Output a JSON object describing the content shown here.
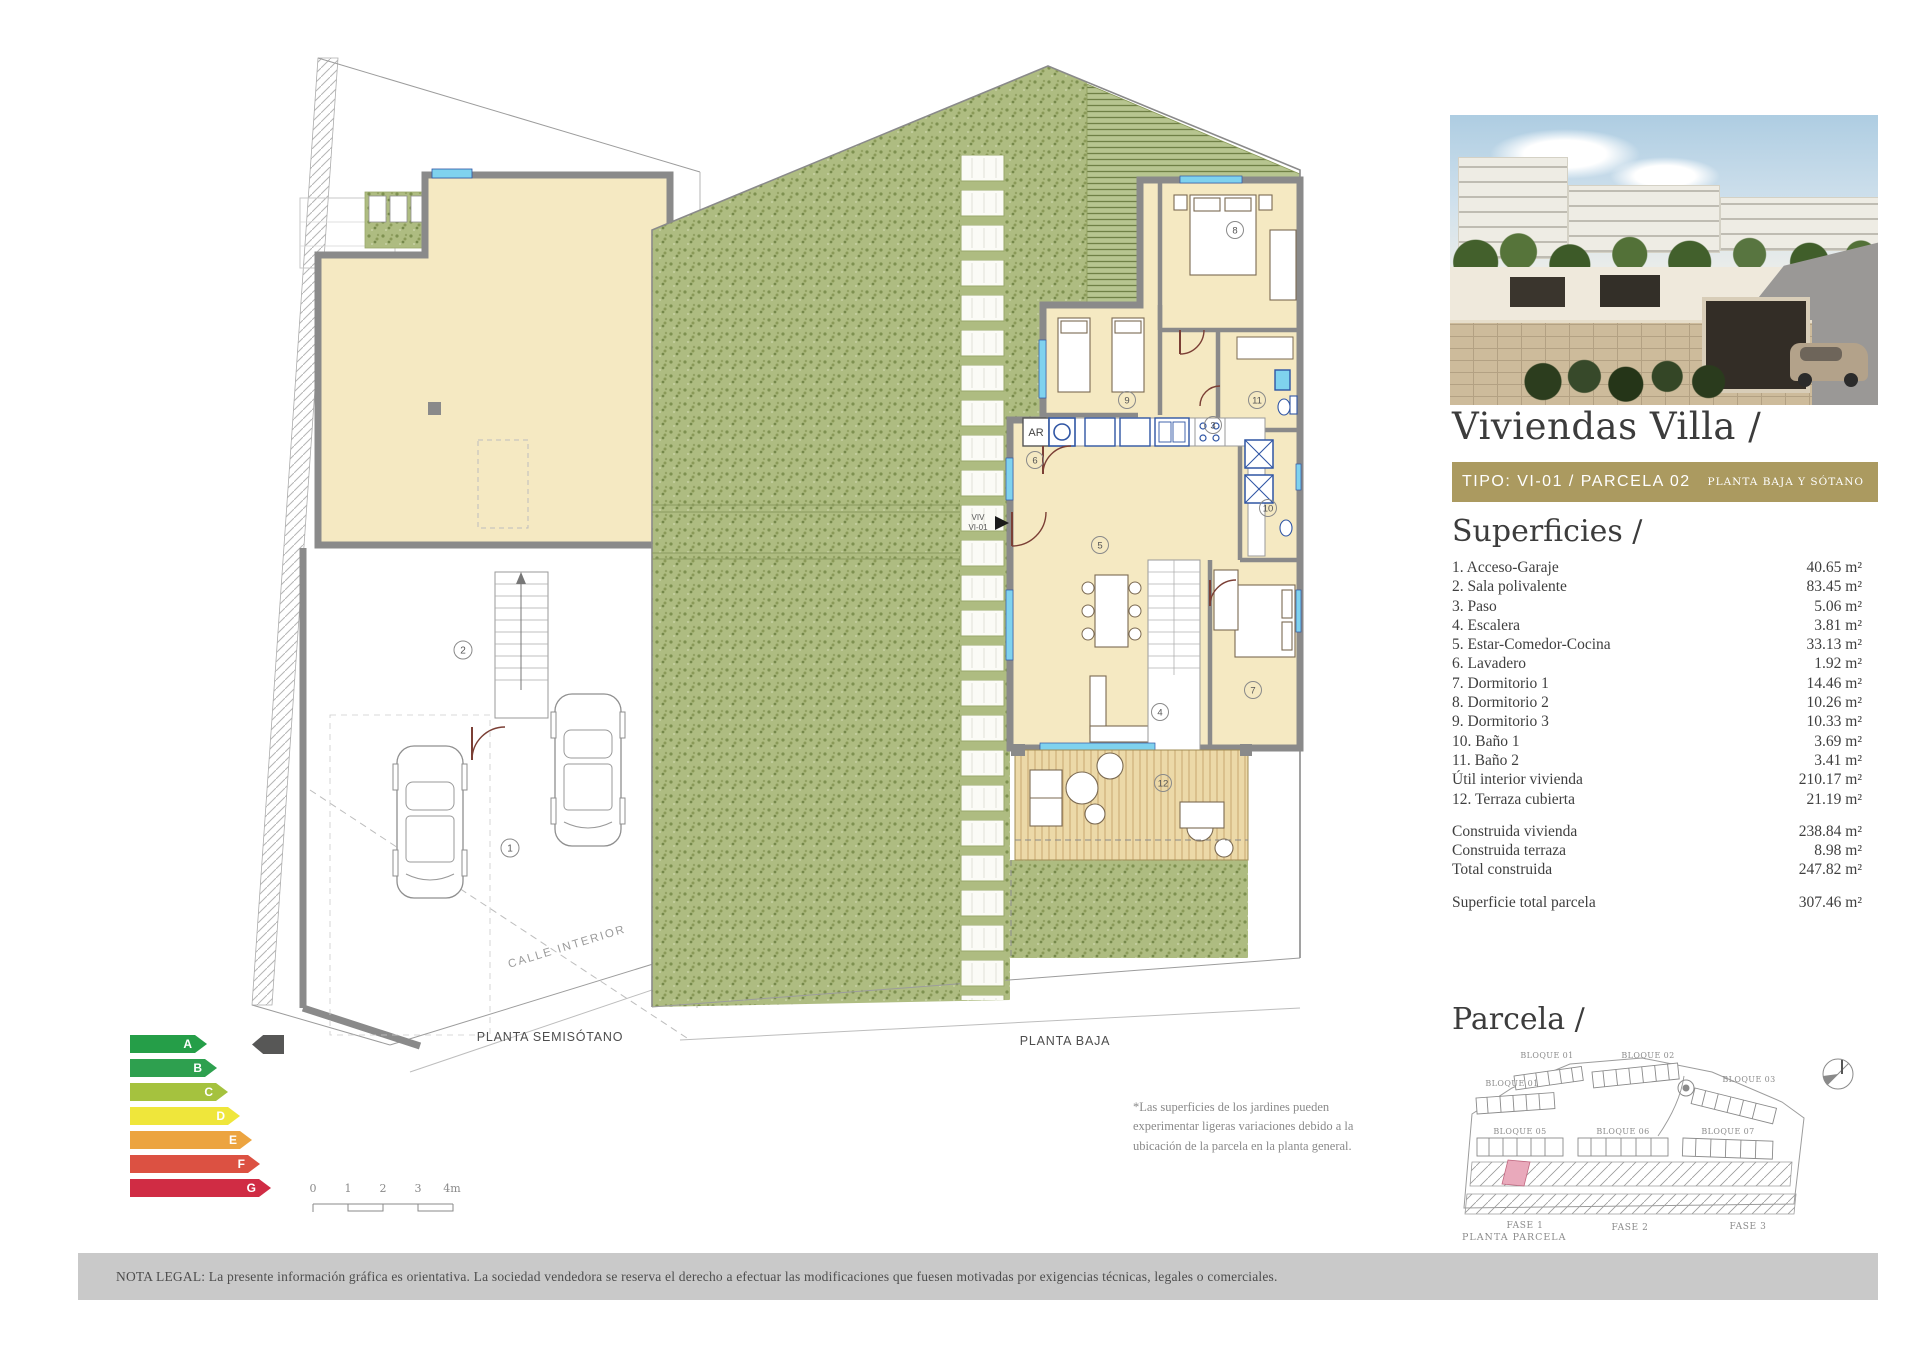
{
  "right_panel": {
    "title": "Viviendas Villa /",
    "type_bar": {
      "left": "TIPO: VI-01 / PARCELA 02",
      "right": "PLANTA BAJA Y SÓTANO",
      "bg": "#ab9a60"
    },
    "superficies": {
      "heading": "Superficies /",
      "rows": [
        {
          "label": "1. Acceso-Garaje",
          "value": "40.65 m²"
        },
        {
          "label": "2. Sala polivalente",
          "value": "83.45 m²"
        },
        {
          "label": "3. Paso",
          "value": "5.06 m²"
        },
        {
          "label": "4. Escalera",
          "value": "3.81 m²"
        },
        {
          "label": "5. Estar-Comedor-Cocina",
          "value": "33.13 m²"
        },
        {
          "label": "6. Lavadero",
          "value": "1.92 m²"
        },
        {
          "label": "7. Dormitorio 1",
          "value": "14.46 m²"
        },
        {
          "label": "8. Dormitorio 2",
          "value": "10.26 m²"
        },
        {
          "label": "9. Dormitorio 3",
          "value": "10.33 m²"
        },
        {
          "label": "10. Baño 1",
          "value": "3.69 m²"
        },
        {
          "label": "11. Baño 2",
          "value": "3.41 m²"
        },
        {
          "label": "Útil interior vivienda",
          "value": "210.17 m²"
        },
        {
          "label": "12. Terraza cubierta",
          "value": "21.19 m²"
        }
      ],
      "totals": [
        {
          "label": "Construida vivienda",
          "value": "238.84 m²"
        },
        {
          "label": "Construida terraza",
          "value": "8.98 m²"
        },
        {
          "label": "Total construida",
          "value": "247.82 m²"
        }
      ],
      "grand_total": {
        "label": "Superficie total parcela",
        "value": "307.46 m²"
      }
    },
    "parcela": {
      "heading": "Parcela /",
      "bloques": [
        "BLOQUE 01",
        "BLOQUE 02",
        "BLOQUE 03",
        "BLOQUE 01",
        "BLOQUE 05",
        "BLOQUE 06",
        "BLOQUE 07"
      ],
      "fases": [
        "FASE 1",
        "FASE 2",
        "FASE 3"
      ],
      "caption": "PLANTA PARCELA",
      "highlight_color": "#e9a9bb"
    }
  },
  "plans": {
    "semisotano": {
      "caption": "PLANTA SEMISÓTANO",
      "street_label": "CALLE INTERIOR",
      "rooms": [
        "1",
        "2"
      ]
    },
    "baja": {
      "caption": "PLANTA BAJA",
      "entry_line1": "VIV",
      "entry_line2": "VI-01",
      "ar_label": "AR",
      "rooms": [
        "3",
        "4",
        "5",
        "6",
        "7",
        "8",
        "9",
        "10",
        "11",
        "12"
      ]
    },
    "garden_note": "*Las superficies de los jardines pueden\nexperimentar ligeras variaciones debido a la\nubicación de la parcela en la planta general."
  },
  "energy_chart": {
    "levels": [
      {
        "letter": "A",
        "color": "#259e48"
      },
      {
        "letter": "B",
        "color": "#2ea04f"
      },
      {
        "letter": "C",
        "color": "#a5c23e"
      },
      {
        "letter": "D",
        "color": "#efe63b"
      },
      {
        "letter": "E",
        "color": "#eca440"
      },
      {
        "letter": "F",
        "color": "#dc5142"
      },
      {
        "letter": "G",
        "color": "#d02c44"
      }
    ],
    "pointer_color": "#575756"
  },
  "scale_bar": {
    "labels": [
      "0",
      "1",
      "2",
      "3",
      "4m"
    ]
  },
  "legal_note": "NOTA LEGAL: La presente información gráfica es orientativa. La sociedad vendedora se reserva el derecho a efectuar las modificaciones que fuesen motivadas por exigencias técnicas, legales o comerciales."
}
